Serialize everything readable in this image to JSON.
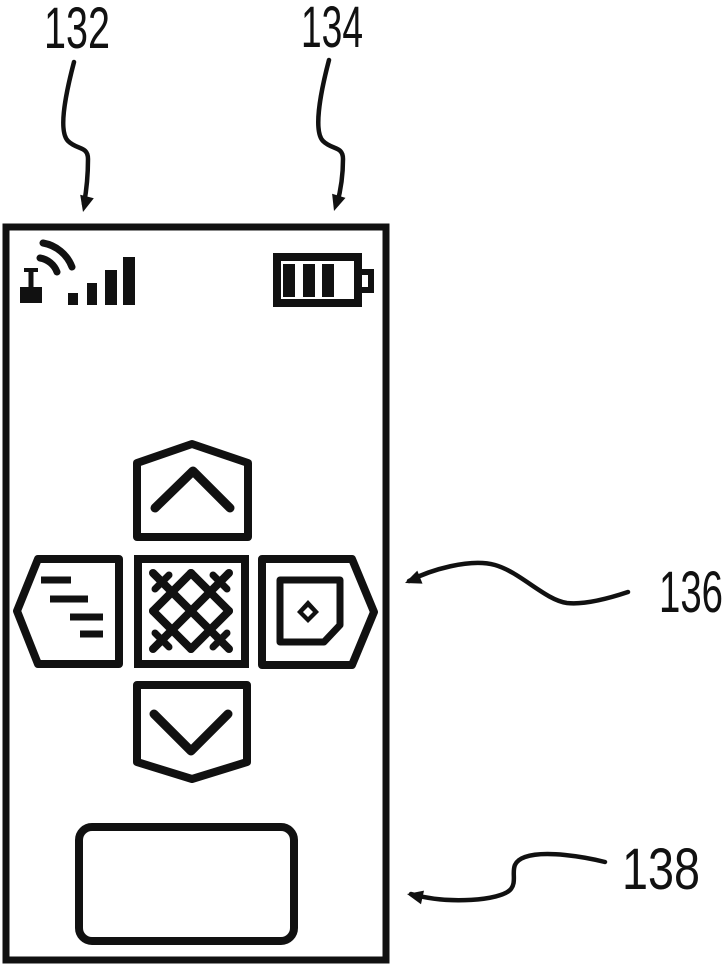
{
  "figure": {
    "background_color": "#ffffff",
    "ink_color": "#111111",
    "reference_labels": {
      "r132": "132",
      "r134": "134",
      "r136": "136",
      "r138": "138"
    }
  },
  "device": {
    "status_bar": {
      "signal": {
        "icon": "antenna-signal-icon",
        "bars_shown": 4
      },
      "battery": {
        "icon": "battery-icon",
        "segments_shown": 3
      }
    },
    "nav_pad": {
      "up": {
        "icon": "chevron-up-icon"
      },
      "down": {
        "icon": "chevron-down-icon"
      },
      "left": {
        "icon": "text-lines-icon"
      },
      "center": {
        "icon": "crosshatch-icon"
      },
      "right": {
        "icon": "screen-dot-icon"
      }
    }
  }
}
